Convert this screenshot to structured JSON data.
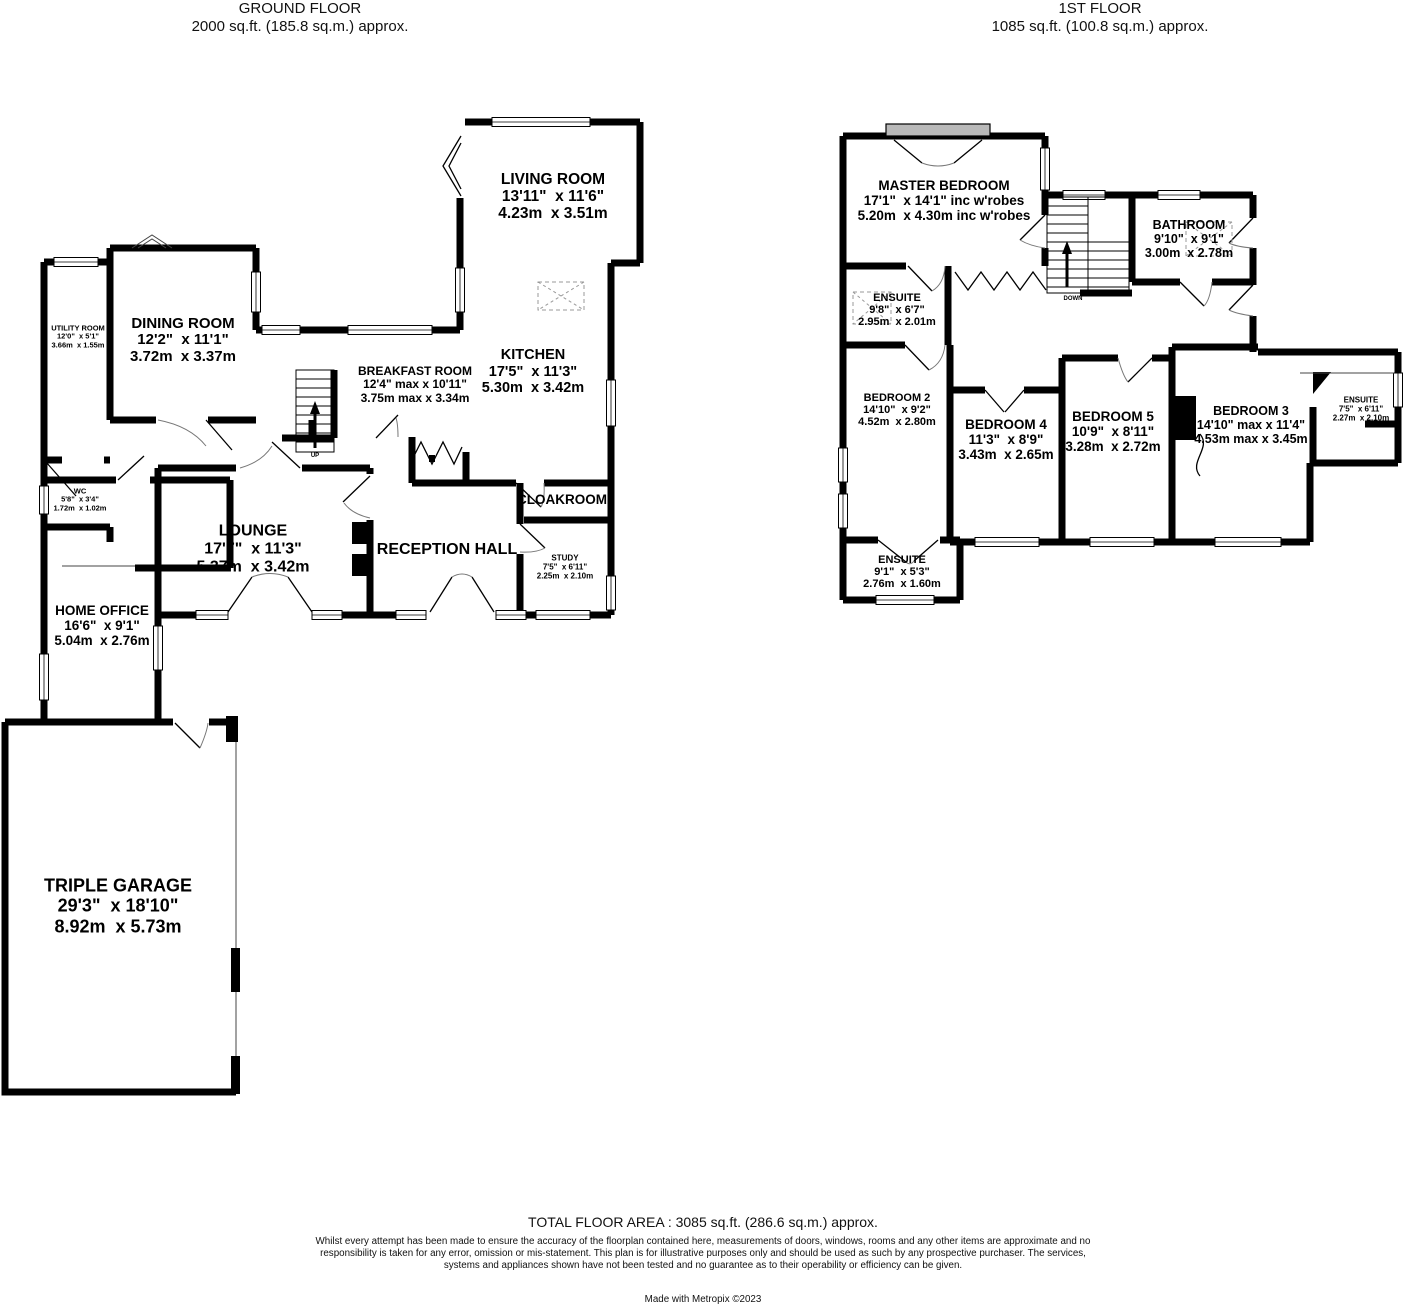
{
  "ground_floor": {
    "title": "GROUND FLOOR",
    "subtitle": "2000 sq.ft. (185.8 sq.m.) approx.",
    "stairs_label": "UP",
    "rooms": [
      {
        "name": "LIVING ROOM",
        "imperial": "13'11\"  x 11'6\"",
        "metric": "4.23m  x 3.51m"
      },
      {
        "name": "DINING ROOM",
        "imperial": "12'2\"  x 11'1\"",
        "metric": "3.72m  x 3.37m"
      },
      {
        "name": "UTILITY ROOM",
        "imperial": "12'0\"  x 5'1\"",
        "metric": "3.66m  x 1.55m"
      },
      {
        "name": "BREAKFAST ROOM",
        "imperial": "12'4\" max x 10'11\"",
        "metric": "3.75m max x 3.34m"
      },
      {
        "name": "KITCHEN",
        "imperial": "17'5\"  x 11'3\"",
        "metric": "5.30m  x 3.42m"
      },
      {
        "name": "WC",
        "imperial": "5'8\"  x 3'4\"",
        "metric": "1.72m  x 1.02m"
      },
      {
        "name": "LOUNGE",
        "imperial": "17'7\"  x 11'3\"",
        "metric": "5.37m  x 3.42m"
      },
      {
        "name": "RECEPTION HALL",
        "imperial": "",
        "metric": ""
      },
      {
        "name": "CLOAKROOM",
        "imperial": "",
        "metric": ""
      },
      {
        "name": "STUDY",
        "imperial": "7'5\"  x 6'11\"",
        "metric": "2.25m  x 2.10m"
      },
      {
        "name": "HOME OFFICE",
        "imperial": "16'6\"  x 9'1\"",
        "metric": "5.04m  x 2.76m"
      },
      {
        "name": "TRIPLE GARAGE",
        "imperial": "29'3\"  x 18'10\"",
        "metric": "8.92m  x 5.73m"
      }
    ]
  },
  "first_floor": {
    "title": "1ST FLOOR",
    "subtitle": "1085 sq.ft. (100.8 sq.m.) approx.",
    "stairs_label": "DOWN",
    "rooms": [
      {
        "name": "MASTER BEDROOM",
        "imperial": "17'1\"  x 14'1\" inc w'robes",
        "metric": "5.20m  x 4.30m inc w'robes"
      },
      {
        "name": "ENSUITE",
        "imperial": "9'8\"  x 6'7\"",
        "metric": "2.95m  x 2.01m"
      },
      {
        "name": "BATHROOM",
        "imperial": "9'10\"  x 9'1\"",
        "metric": "3.00m  x 2.78m"
      },
      {
        "name": "BEDROOM 2",
        "imperial": "14'10\"  x 9'2\"",
        "metric": "4.52m  x 2.80m"
      },
      {
        "name": "BEDROOM 4",
        "imperial": "11'3\"  x 8'9\"",
        "metric": "3.43m  x 2.65m"
      },
      {
        "name": "BEDROOM 5",
        "imperial": "10'9\"  x 8'11\"",
        "metric": "3.28m  x 2.72m"
      },
      {
        "name": "BEDROOM 3",
        "imperial": "14'10\" max x 11'4\"",
        "metric": "4.53m max x 3.45m"
      },
      {
        "name": "ENSUITE",
        "imperial": "7'5\"  x 6'11\"",
        "metric": "2.27m  x 2.10m"
      },
      {
        "name": "ENSUITE",
        "imperial": "9'1\"  x 5'3\"",
        "metric": "2.76m  x 1.60m"
      }
    ]
  },
  "footer": {
    "total": "TOTAL FLOOR AREA : 3085 sq.ft. (286.6 sq.m.) approx.",
    "disclaimer": "Whilst every attempt has been made to ensure the accuracy of the floorplan contained here, measurements of doors, windows, rooms and any other items are approximate and no responsibility is taken for any error, omission or mis-statement. This plan is for illustrative purposes only and should be used as such by any prospective purchaser. The services, systems and appliances shown have not been tested and no guarantee as to their operability or efficiency can be given.",
    "credit": "Made with Metropix ©2023"
  }
}
